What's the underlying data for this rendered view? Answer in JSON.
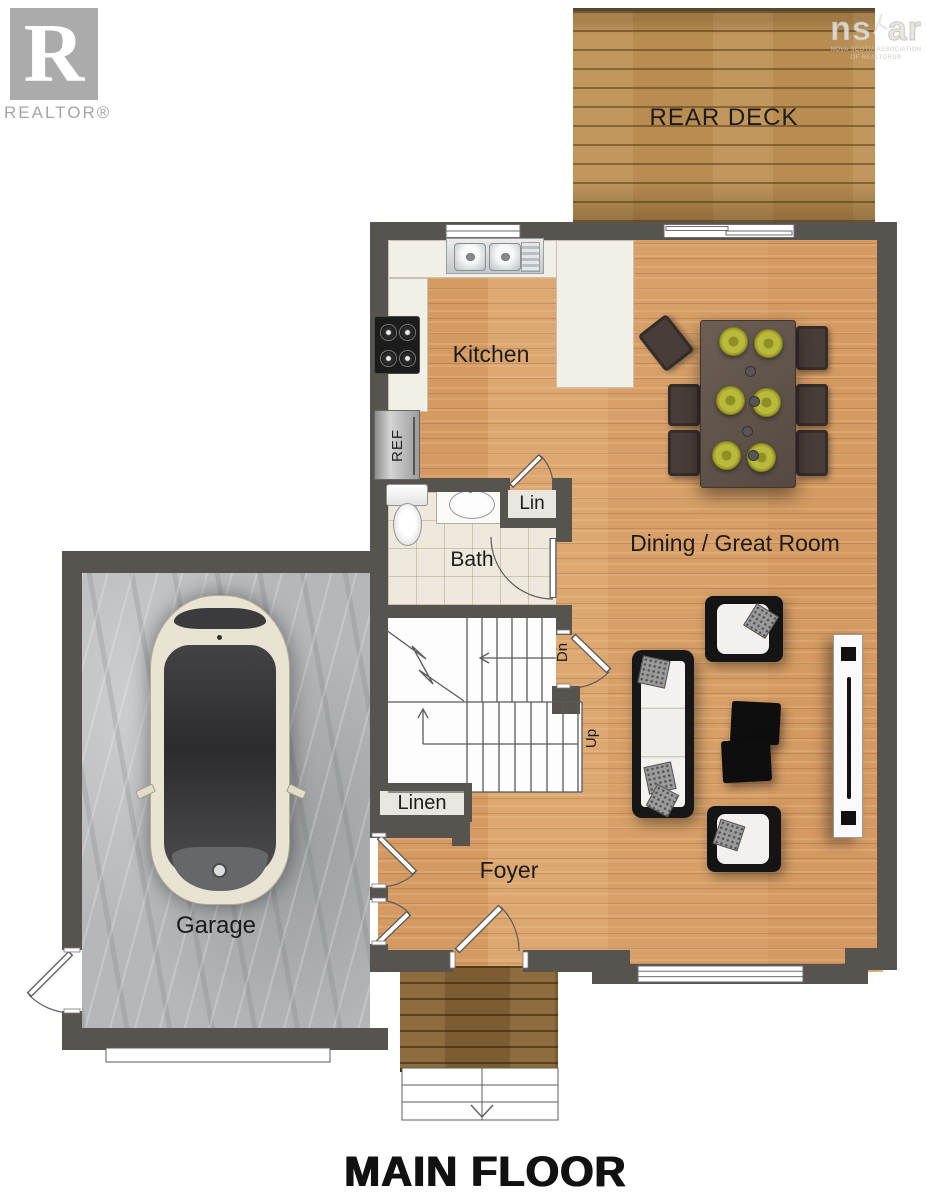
{
  "branding": {
    "realtor": {
      "monogram": "R",
      "label": "REALTOR®"
    },
    "watermark": {
      "ns": "ns",
      "ar": "ar",
      "caption_line1": "NOVA SCOTIA ASSOCIATION",
      "caption_line2": "OF REALTORS®"
    }
  },
  "floorplan": {
    "title": "MAIN FLOOR",
    "rooms": {
      "rear_deck": "REAR DECK",
      "kitchen": "Kitchen",
      "dining_great_room": "Dining / Great Room",
      "bath": "Bath",
      "lin_closet": "Lin",
      "linen_closet": "Linen",
      "foyer": "Foyer",
      "garage": "Garage"
    },
    "annotations": {
      "fridge": "REF",
      "stairs_down": "Dn",
      "stairs_up": "Up"
    }
  },
  "colors": {
    "wall": "#57534f",
    "interior_floor": "#d8a26b",
    "deck_wood": "#b98d52",
    "porch_wood": "#7d5c31",
    "garage_concrete": "#b5b8ba",
    "counter": "#f2efe6",
    "plate_accent": "#b9b93a"
  }
}
